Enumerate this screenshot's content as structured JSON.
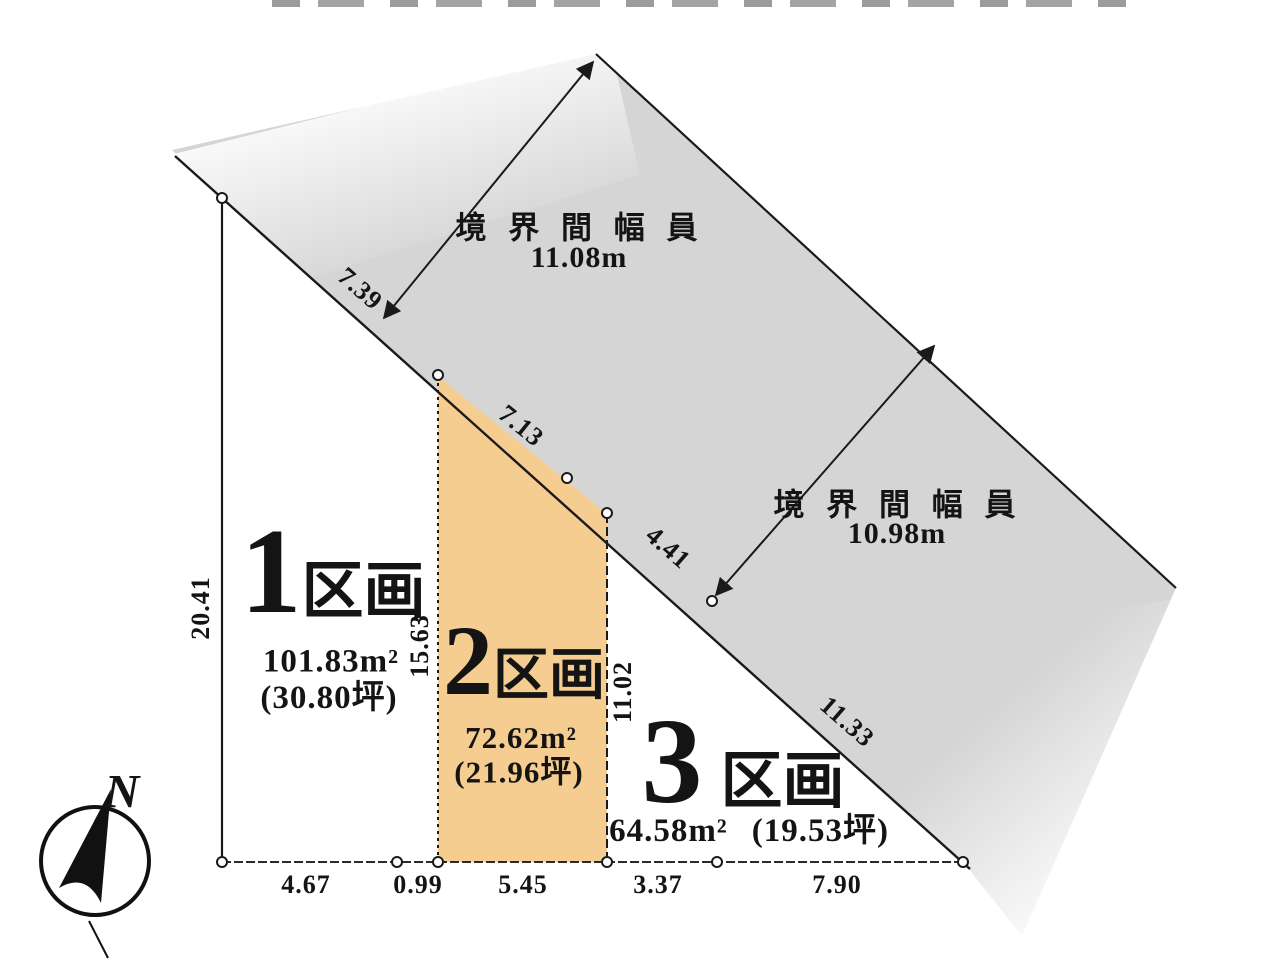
{
  "compass": {
    "north": "N"
  },
  "road_labels": [
    {
      "title": "境 界 間 幅 員",
      "width": "11.08m"
    },
    {
      "title": "境 界 間 幅 員",
      "width": "10.98m"
    }
  ],
  "plots": [
    {
      "number": "1",
      "type": "区画",
      "area": "101.83m²",
      "tsubo": "(30.80坪)"
    },
    {
      "number": "2",
      "type": "区画",
      "area": "72.62m²",
      "tsubo": "(21.96坪)"
    },
    {
      "number": "3",
      "type": "区画",
      "area": "64.58m²",
      "tsubo": "(19.53坪)"
    }
  ],
  "dimensions": {
    "west_edge": "20.41",
    "plot2_west": "15.63",
    "plot2_east": "11.02",
    "road_frontage": [
      "7.39",
      "7.13",
      "4.41",
      "11.33"
    ],
    "south_edge": [
      "4.67",
      "0.99",
      "5.45",
      "3.37",
      "7.90"
    ]
  },
  "colors": {
    "road_fill": "#d5d5d5",
    "plot2_fill": "#f5cd90",
    "line": "#1a1a1a"
  }
}
